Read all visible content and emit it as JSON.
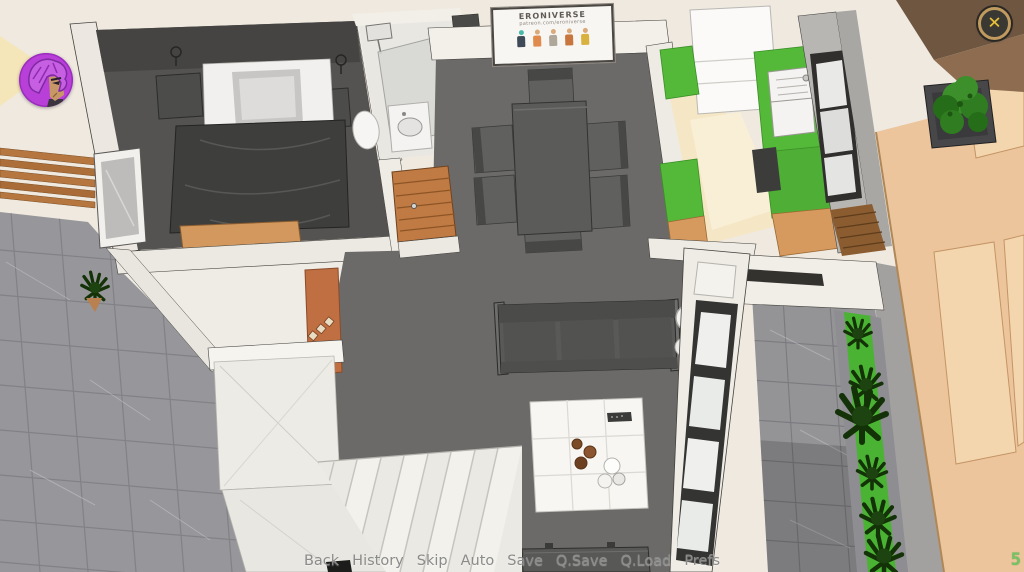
{
  "hud": {
    "avatar_alt": "purple-haired-girl-portrait",
    "close_icon": "✕",
    "day_counter": "5"
  },
  "poster": {
    "title": "ERONIVERSE",
    "subtitle": "patreon.com/eroniverse"
  },
  "quick_menu": {
    "items": [
      "Back",
      "History",
      "Skip",
      "Auto",
      "Save",
      "Q.Save",
      "Q.Load",
      "Prefs"
    ]
  },
  "colors": {
    "menu_text": "#8b8b8b",
    "counter_green": "#76c364",
    "close_gold": "#e6c13d",
    "close_ring": "#c09a5e",
    "avatar_purple": "#b83fd8",
    "kitchen_counter_green": "#54b839",
    "grass_green": "#4ab334",
    "floor_dark": "#6b6a69",
    "wall_cream": "#efe9e0",
    "terrace_wall_tan": "#ecc59d"
  }
}
